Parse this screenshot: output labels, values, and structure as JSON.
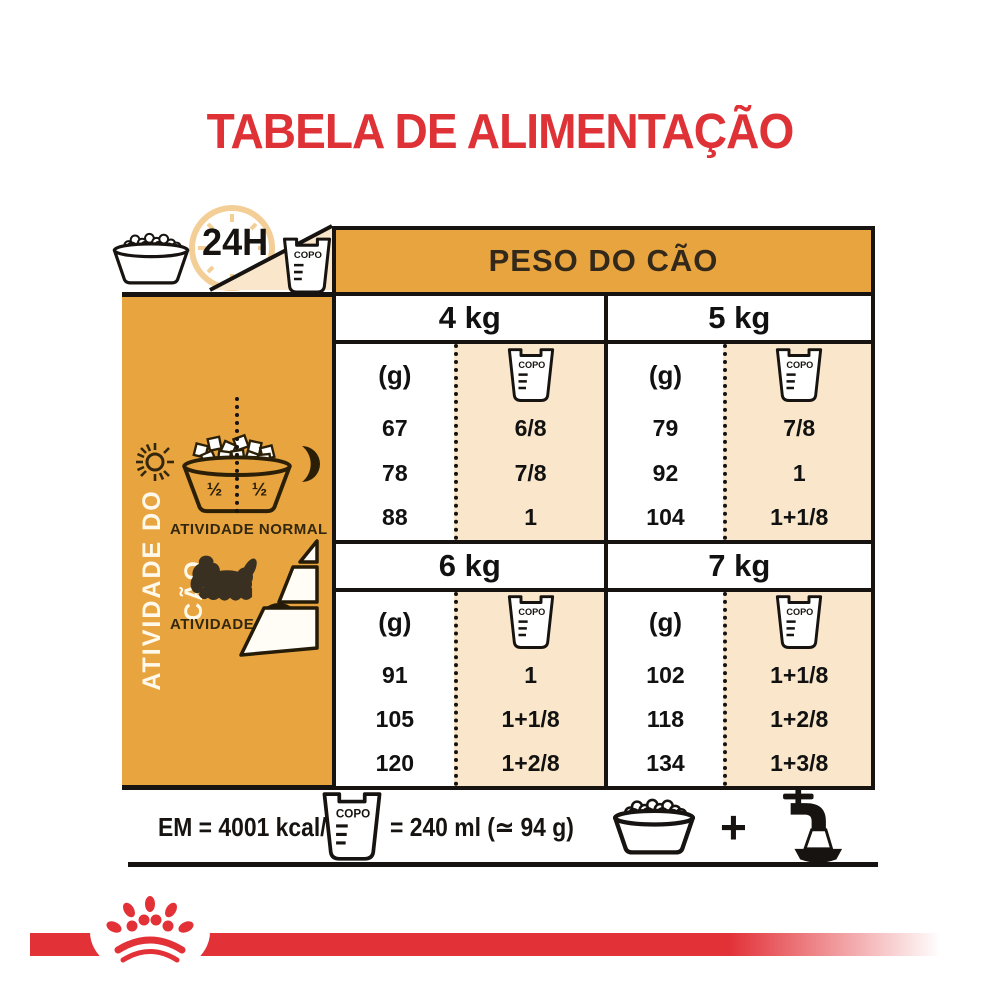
{
  "title": "TABELA DE ALIMENTAÇÃO",
  "top": {
    "hours_label": "24H",
    "copo_label": "COPO",
    "peso_header": "PESO DO CÃO"
  },
  "sidebar": {
    "vertical_label": "ATIVIDADE DO CÃO",
    "half": "½",
    "normal_label": "ATIVIDADE NORMAL",
    "plus_label": "ATIVIDADE",
    "plus_sign": "+"
  },
  "table": {
    "g_label": "(g)",
    "copo_label": "COPO",
    "sections": [
      {
        "weight": "4 kg",
        "rows": [
          {
            "g": "67",
            "copo": "6/8"
          },
          {
            "g": "78",
            "copo": "7/8"
          },
          {
            "g": "88",
            "copo": "1"
          }
        ]
      },
      {
        "weight": "5 kg",
        "rows": [
          {
            "g": "79",
            "copo": "7/8"
          },
          {
            "g": "92",
            "copo": "1"
          },
          {
            "g": "104",
            "copo": "1+1/8"
          }
        ]
      },
      {
        "weight": "6 kg",
        "rows": [
          {
            "g": "91",
            "copo": "1"
          },
          {
            "g": "105",
            "copo": "1+1/8"
          },
          {
            "g": "120",
            "copo": "1+2/8"
          }
        ]
      },
      {
        "weight": "7 kg",
        "rows": [
          {
            "g": "102",
            "copo": "1+1/8"
          },
          {
            "g": "118",
            "copo": "1+2/8"
          },
          {
            "g": "134",
            "copo": "1+3/8"
          }
        ]
      }
    ]
  },
  "footer": {
    "energy": "EM = 4001 kcal/kg",
    "copo_label": "COPO",
    "equivalence": "= 240 ml (≃ 94 g)",
    "plus_sign": "+"
  },
  "colors": {
    "orange": "#E8A43E",
    "cream": "#FAE7CB",
    "red": "#DE3237",
    "stripe_red": "#E23238",
    "ink": "#161310"
  },
  "icons": {
    "food_bowl": "bowl of kibble",
    "clock": "24h dial",
    "measuring_cup": "copo cup",
    "sun": "day",
    "moon": "night",
    "dog": "shih-tzu silhouette",
    "activity_wedges": "activity level steps",
    "water_tap": "tap + water bowl",
    "crown": "paw-crown emblem"
  }
}
